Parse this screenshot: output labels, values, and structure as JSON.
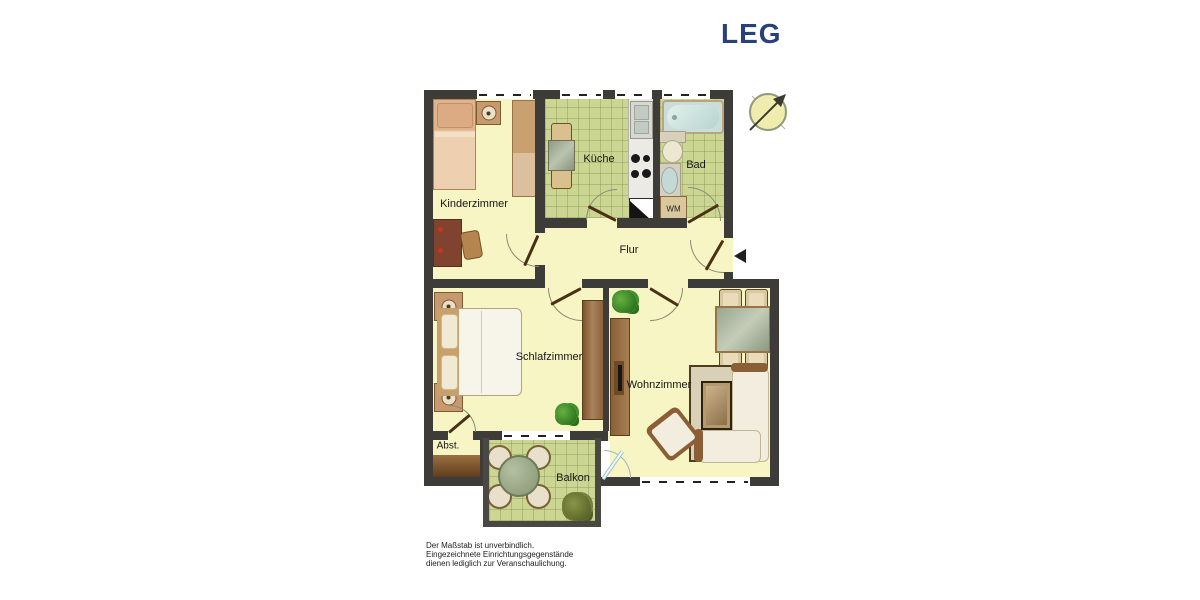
{
  "logo": {
    "text": "LEG",
    "color": "#27417d"
  },
  "rooms": {
    "kinderzimmer": {
      "label": "Kinderzimmer"
    },
    "kueche": {
      "label": "Küche"
    },
    "bad": {
      "label": "Bad"
    },
    "flur": {
      "label": "Flur"
    },
    "schlafzimmer": {
      "label": "Schlafzimmer"
    },
    "wohnzimmer": {
      "label": "Wohnzimmer"
    },
    "abstellraum": {
      "label": "Abst."
    },
    "balkon": {
      "label": "Balkon"
    }
  },
  "appliances": {
    "washing_machine_label": "WM"
  },
  "disclaimer": {
    "line1": "Der Maßstab ist unverbindlich.",
    "line2": "Eingezeichnete Einrichtungsgegenstände",
    "line3": "dienen lediglich zur Veranschaulichung."
  },
  "icons": {
    "compass": "north-arrow",
    "entrance": "entrance-direction-arrow"
  },
  "colors": {
    "wall": "#3e3c38",
    "floor_cream": "#f7f5c3",
    "tile_green": "#ccd693",
    "logo_navy": "#27417d",
    "bathtub_blue": "#cfe3df",
    "door_brown": "#4a3014"
  }
}
